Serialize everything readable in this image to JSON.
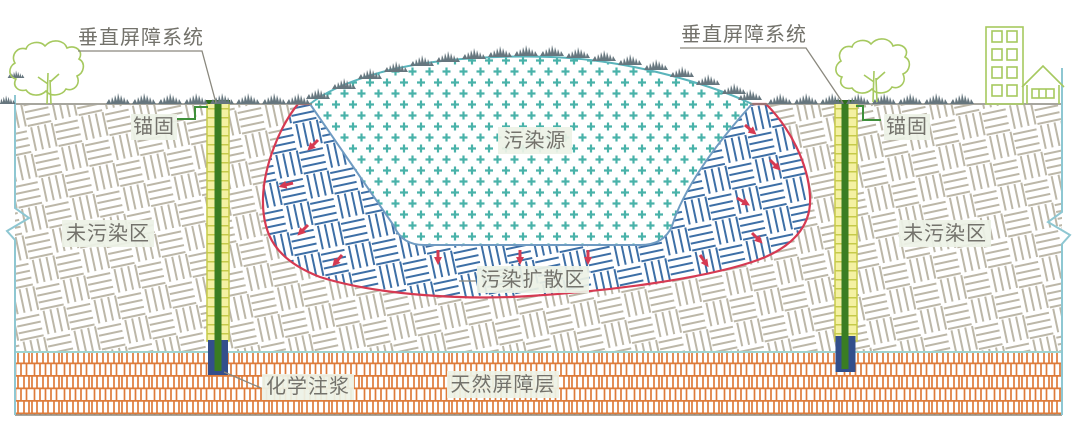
{
  "labels": {
    "vertical_barrier_system_left": "垂直屏障系统",
    "vertical_barrier_system_right": "垂直屏障系统",
    "anchor_left": "锚固",
    "anchor_right": "锚固",
    "uncontaminated_zone_left": "未污染区",
    "uncontaminated_zone_right": "未污染区",
    "pollution_source": "污染源",
    "pollution_diffusion_zone": "污染扩散区",
    "chemical_grouting": "化学注浆",
    "natural_barrier_layer": "天然屏障层"
  },
  "colors": {
    "uncontaminated_hatch": "#bcb7a8",
    "diffusion_hatch": "#3d6fa6",
    "diffusion_boundary_red": "#d63a52",
    "source_cross_teal": "#49b2a9",
    "source_boundary_blue": "#6f9bc2",
    "mound_outline_teal": "#5ab4bb",
    "natural_barrier_orange": "#de7b3a",
    "barrier_yellow": "#f4f1a2",
    "barrier_ladder": "#c6ca4a",
    "barrier_green_liner": "#3a7d22",
    "grouting_navy": "#334f8c",
    "anchor_line_green": "#3f8f3a",
    "vegetation_green": "#a6c95f",
    "bush_gray": "#66767e",
    "ground_line_gray": "#8a887e",
    "border_teal": "#8ec7d2",
    "label_text_gray": "#73726b"
  }
}
